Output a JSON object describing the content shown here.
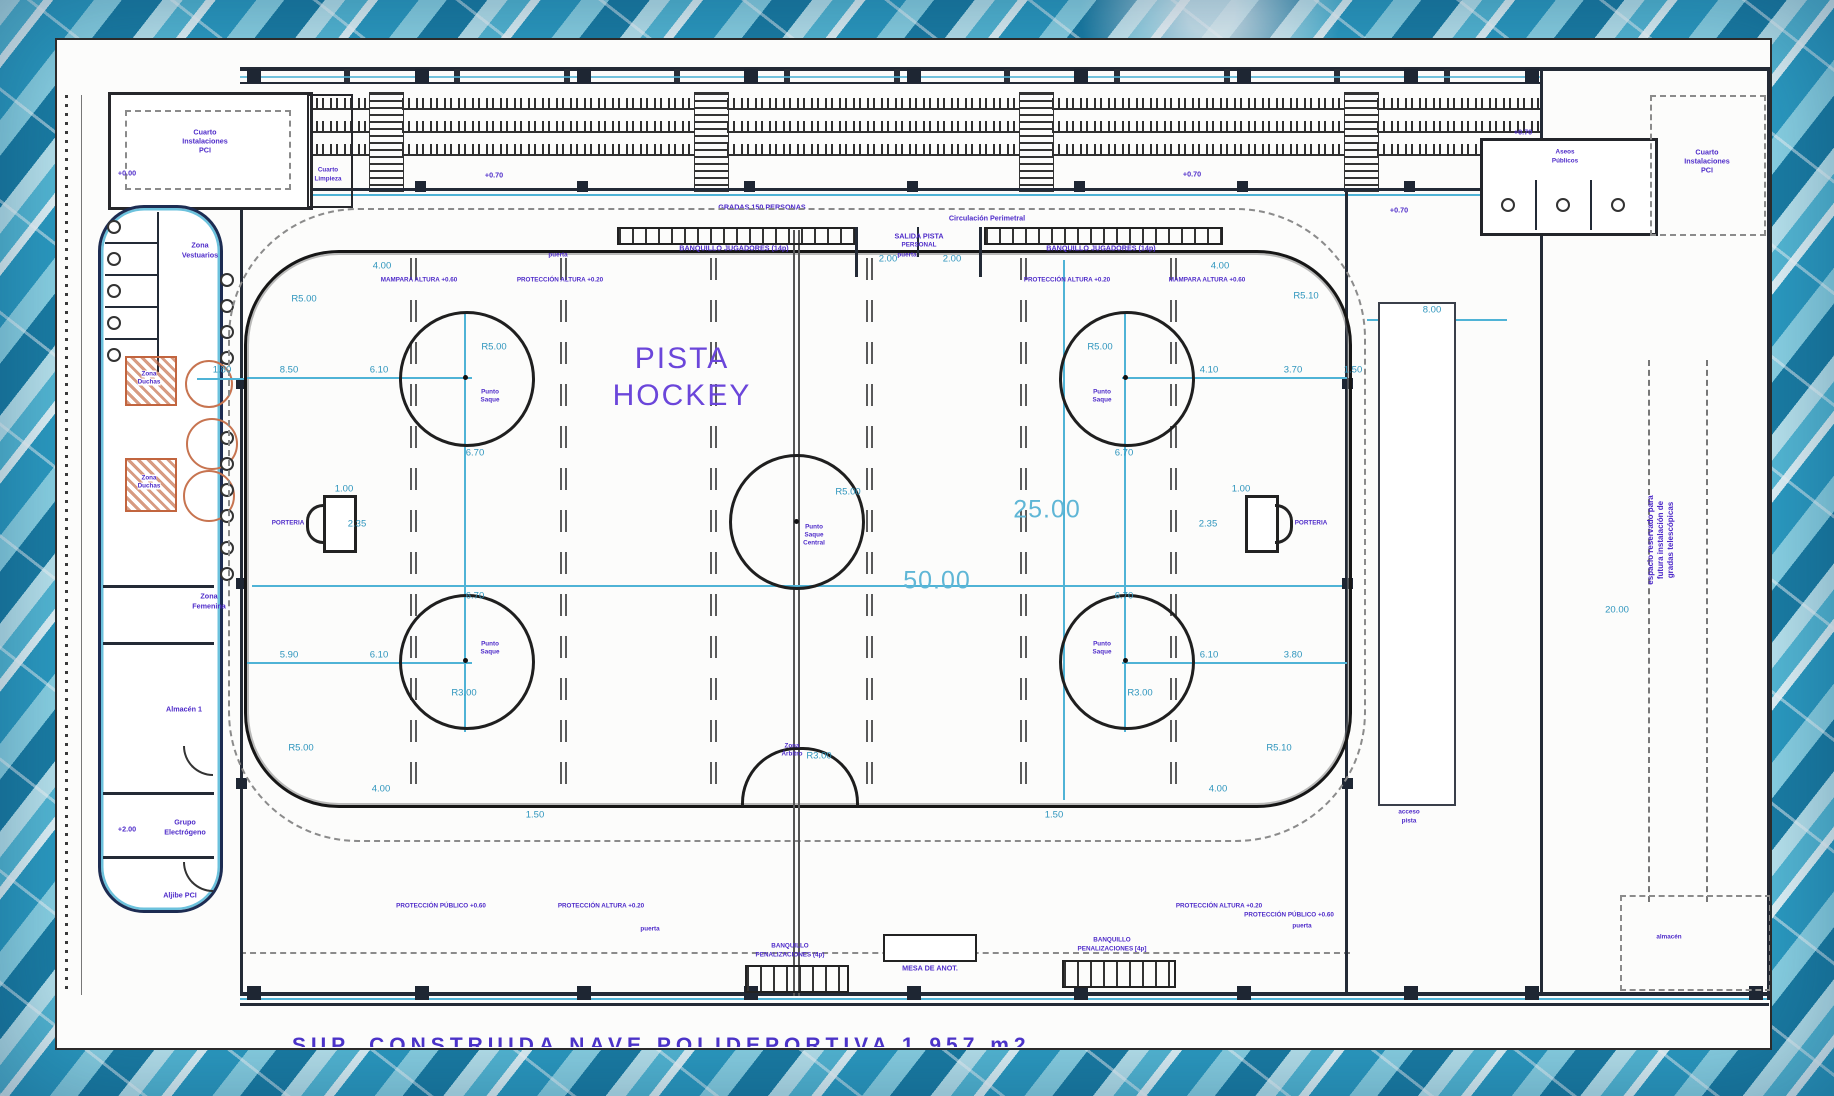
{
  "plan": {
    "title_l1": "PISTA",
    "title_l2": "HOCKEY",
    "caption": "SUP. CONSTRUIDA NAVE POLIDEPORTIVA  1.957 m2"
  },
  "labels": {
    "gradas": "GRADAS 150 PERSONAS",
    "circulacion": "Circulación Perimetral",
    "banq_jug": "BANQUILLO JUGADORES (14p)",
    "salida_l1": "SALIDA PISTA",
    "salida_l2": "PERSONAL",
    "mampara": "MAMPARA ALTURA +0.60",
    "proteccion": "PROTECCIÓN ALTURA +0.20",
    "prot_publico": "PROTECCIÓN PÚBLICO +0.60",
    "banq_pen_l1": "BANQUILLO",
    "banq_pen_l2": "PENALIZACIONES (4p)",
    "banq_pen_r2": "PENALIZACIONES [4p]",
    "mesa": "MESA DE ANOT.",
    "porteria": "PORTERIA",
    "puerta": "puerta",
    "punto_l1": "Punto",
    "punto_l2": "Saque",
    "punto_l3": "Central",
    "arbitro_l1": "Zona",
    "arbitro_l2": "Árbitro"
  },
  "rooms": {
    "vestuarios_l1": "Zona",
    "vestuarios_l2": "Vestuarios",
    "duchas_l1": "Zona",
    "duchas_l2": "Duchas",
    "femenina_l1": "Zona",
    "femenina_l2": "Femenina",
    "almacen": "Almacén 1",
    "grupo_l1": "Grupo",
    "grupo_l2": "Electrógeno",
    "aljibe": "Aljibe PCI",
    "instalaciones_l1": "Cuarto",
    "instalaciones_l2": "Instalaciones",
    "instalaciones_l3": "PCI",
    "limpieza_l1": "Cuarto",
    "limpieza_l2": "Limpieza",
    "aseos_l1": "Aseos",
    "aseos_l2": "Públicos",
    "acceso_l1": "acceso",
    "acceso_l2": "pista",
    "almacen2": "almacén",
    "nota_l1": "espacio reservado para",
    "nota_l2": "futura instalación de",
    "nota_l3": "gradas telescópicas"
  },
  "dims": [
    "4.00",
    "4.00",
    "R5.00",
    "R5.10",
    "8.50",
    "6.10",
    "1.80",
    "4.10",
    "3.70",
    "1.50",
    "R5.00",
    "R5.00",
    "6.70",
    "6.70",
    "6.70",
    "6.70",
    "R3.00",
    "R3.00",
    "5.90",
    "6.10",
    "6.10",
    "3.80",
    "R5.00",
    "R5.10",
    "4.00",
    "4.00",
    "1.50",
    "1.50",
    "2.35",
    "2.35",
    "1.00",
    "1.00",
    "R5.00",
    "R3.00",
    "2.00",
    "2.00",
    "8.00",
    "20.00",
    "50.00",
    "25.00"
  ],
  "levels": [
    "+0.00",
    "+2.00",
    "+0.70",
    "+0.70",
    "+0.70",
    "+0.70"
  ],
  "colors": {
    "purple": "#4e2bc9",
    "cyan": "#2e95bd",
    "wall": "#232a36",
    "teal": "#4fb3d6",
    "orange": "#c77450"
  }
}
